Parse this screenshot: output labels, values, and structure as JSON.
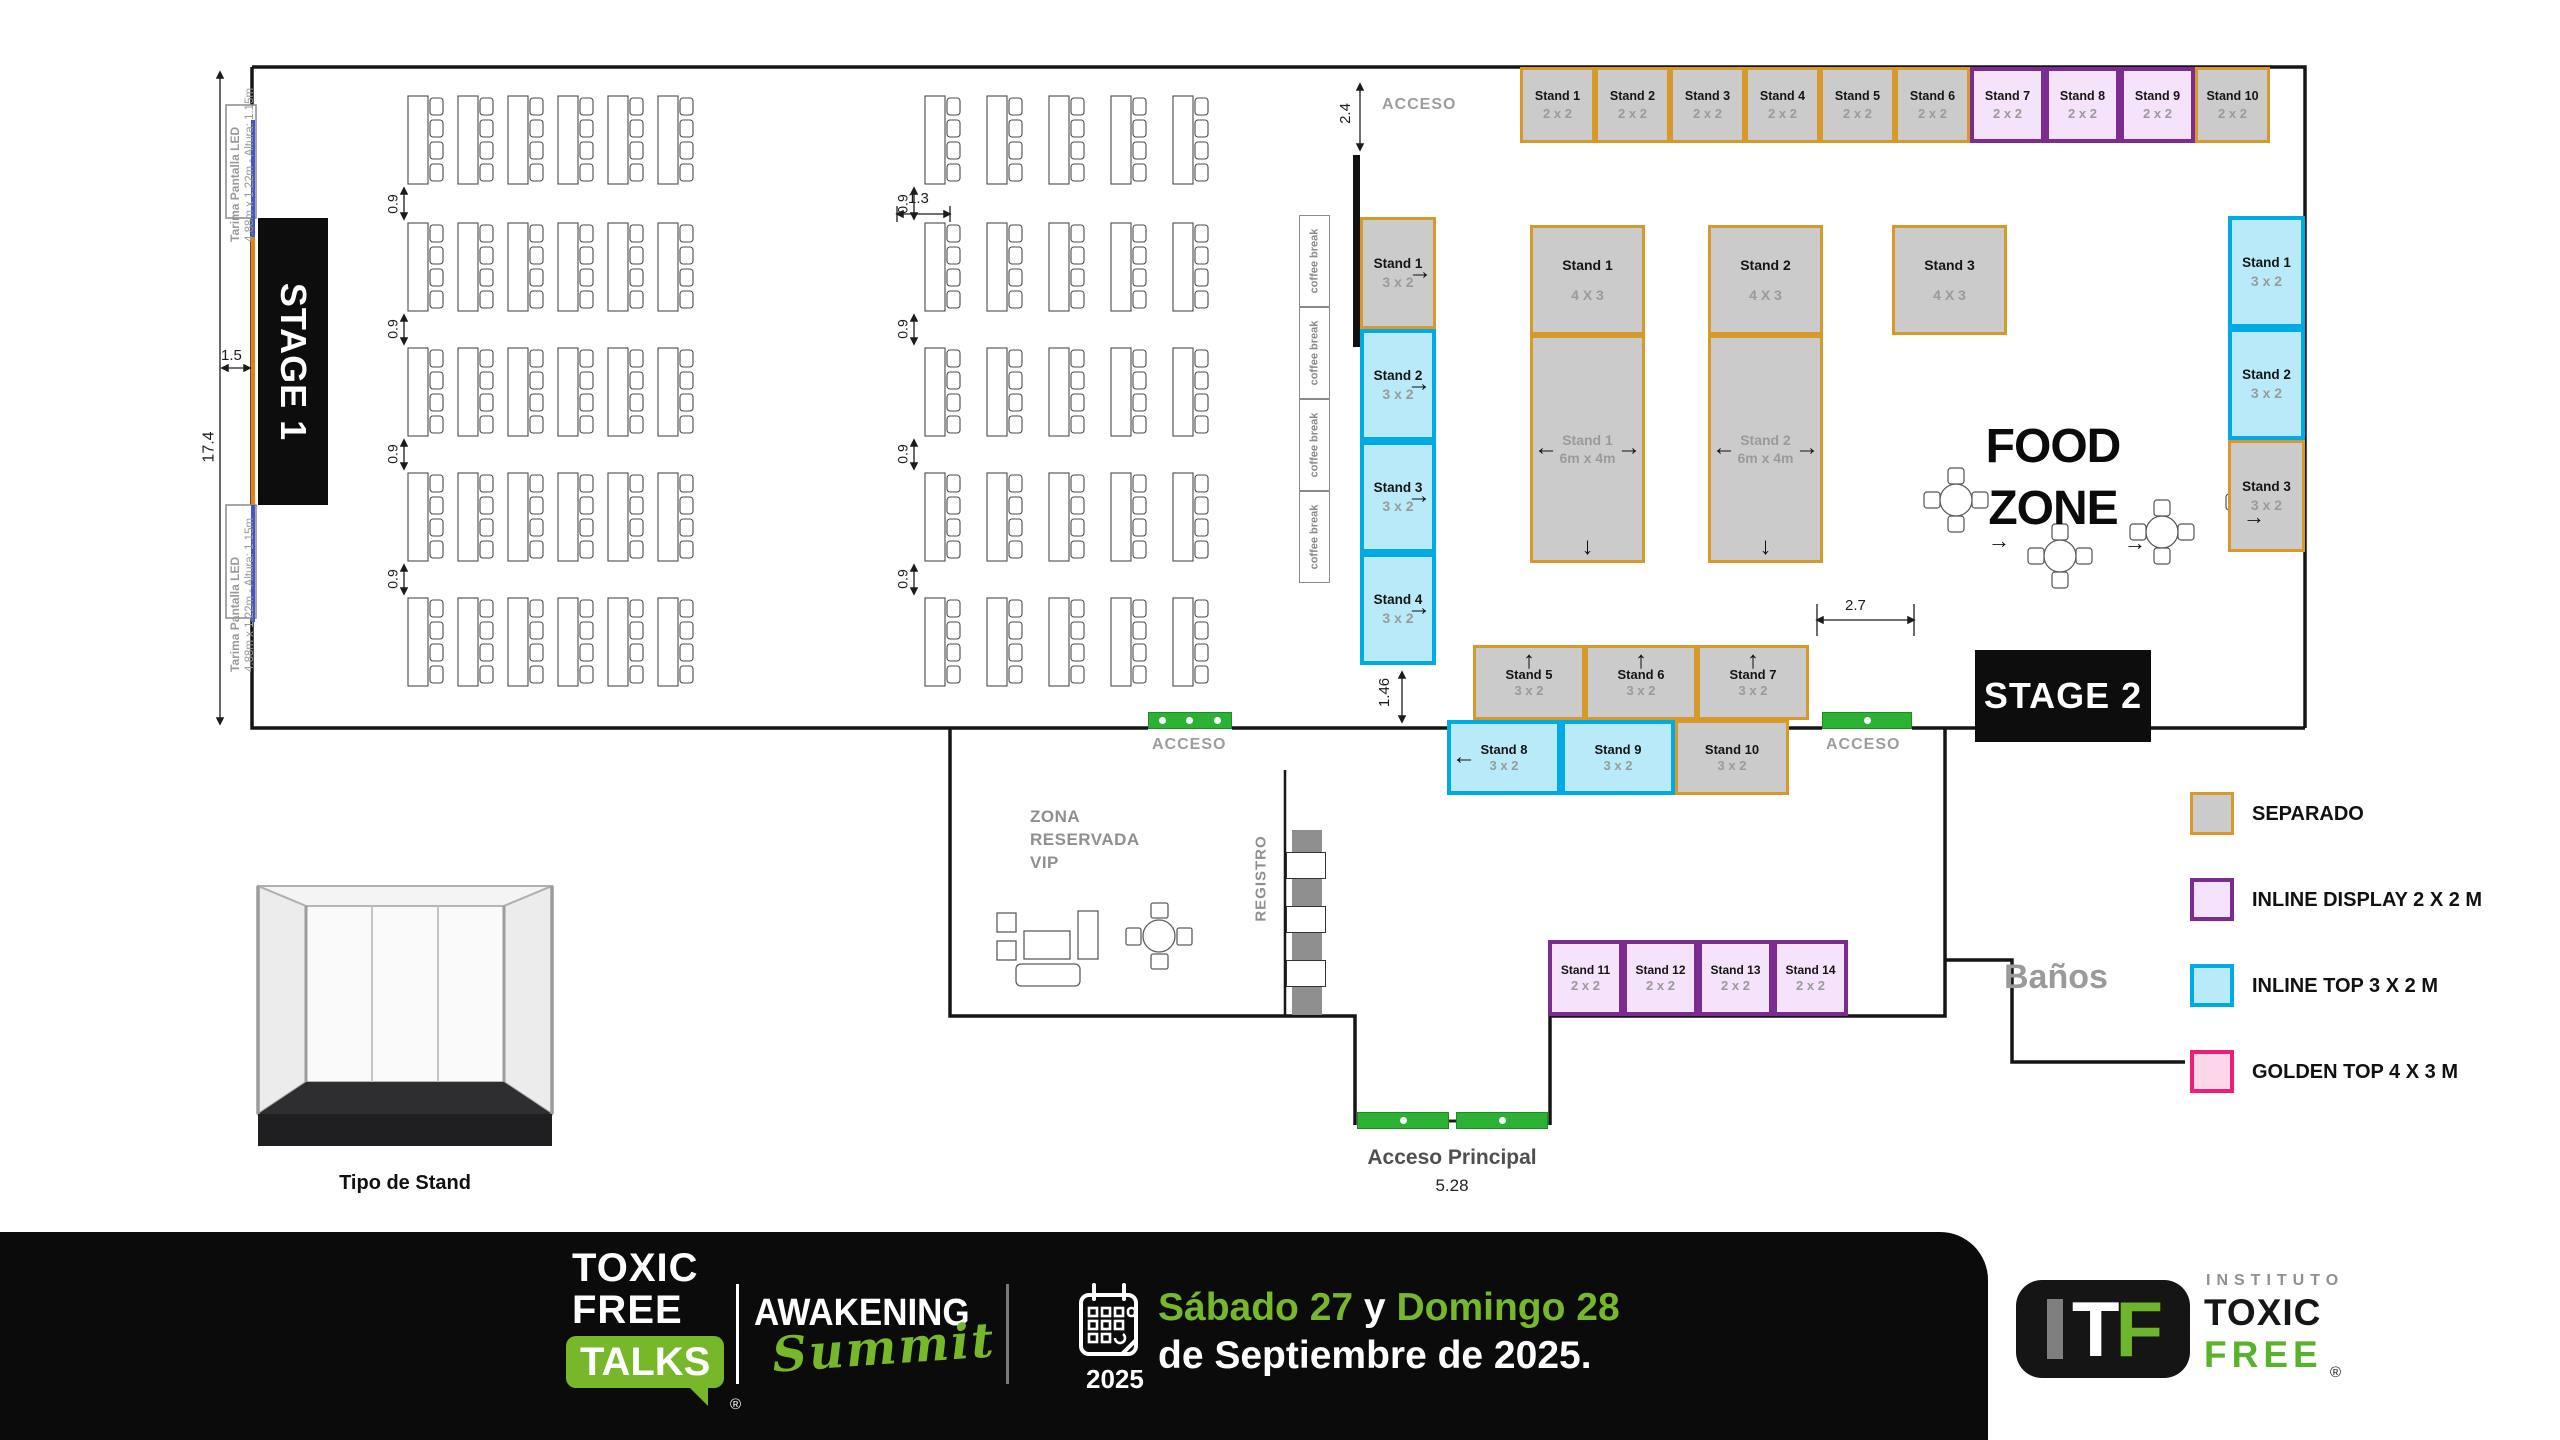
{
  "plan": {
    "stage1_label": "STAGE 1",
    "stage2_label": "STAGE 2",
    "food_zone": [
      "FOOD",
      "ZONE"
    ],
    "banos_label": "Baños",
    "acceso_label": "ACCESO",
    "acceso_principal_label": "Acceso Principal",
    "registro_label": "REGISTRO",
    "vip_lines": [
      "ZONA",
      "RESERVADA",
      "VIP"
    ],
    "coffee_break_label": "coffee break",
    "tarima_title": "Tarima Pantalla LED",
    "tarima_specs": "4.88m x 1.22m - Altura: 1.15m",
    "tipo_de_stand_label": "Tipo de Stand",
    "dimensions": {
      "hall_height": "17.4",
      "stage_offset": "1.5",
      "row_gap": "0.9",
      "cluster_gap": "1.3",
      "top_access": "2.4",
      "left_access": "1.46",
      "stage2_access": "2.7",
      "main_entrance": "5.28"
    }
  },
  "stands": {
    "top_row": [
      {
        "name": "Stand 1",
        "size": "2 x 2",
        "type": "separado"
      },
      {
        "name": "Stand 2",
        "size": "2 x 2",
        "type": "separado"
      },
      {
        "name": "Stand 3",
        "size": "2 x 2",
        "type": "separado"
      },
      {
        "name": "Stand 4",
        "size": "2 x 2",
        "type": "separado"
      },
      {
        "name": "Stand 5",
        "size": "2 x 2",
        "type": "separado"
      },
      {
        "name": "Stand 6",
        "size": "2 x 2",
        "type": "separado"
      },
      {
        "name": "Stand 7",
        "size": "2 x 2",
        "type": "inline_display"
      },
      {
        "name": "Stand 8",
        "size": "2 x 2",
        "type": "inline_display"
      },
      {
        "name": "Stand 9",
        "size": "2 x 2",
        "type": "inline_display"
      },
      {
        "name": "Stand 10",
        "size": "2 x 2",
        "type": "separado"
      }
    ],
    "left_column": [
      {
        "name": "Stand 1",
        "size": "3 x 2",
        "type": "separado",
        "arrows": [
          "right"
        ]
      },
      {
        "name": "Stand 2",
        "size": "3 x 2",
        "type": "inline_top",
        "arrows": [
          "right"
        ]
      },
      {
        "name": "Stand 3",
        "size": "3 x 2",
        "type": "inline_top",
        "arrows": [
          "right"
        ]
      },
      {
        "name": "Stand 4",
        "size": "3 x 2",
        "type": "inline_top",
        "arrows": [
          "right"
        ]
      }
    ],
    "center_large": [
      {
        "name": "Stand 1",
        "size": "4 X 3",
        "type": "separado"
      },
      {
        "name": "Stand 2",
        "size": "4 X 3",
        "type": "separado"
      },
      {
        "name": "Stand 3",
        "size": "4 X 3",
        "type": "separado"
      }
    ],
    "center_separado": [
      {
        "name": "Stand 1",
        "size": "6m x 4m",
        "type": "separado",
        "muted": true,
        "arrows": [
          "left",
          "right",
          "down"
        ]
      },
      {
        "name": "Stand 2",
        "size": "6m x 4m",
        "type": "separado",
        "muted": true,
        "arrows": [
          "left",
          "right",
          "down"
        ]
      }
    ],
    "right_column": [
      {
        "name": "Stand 1",
        "size": "3 x 2",
        "type": "inline_top"
      },
      {
        "name": "Stand 2",
        "size": "3 x 2",
        "type": "inline_top"
      },
      {
        "name": "Stand 3",
        "size": "3 x 2",
        "type": "separado"
      }
    ],
    "bottom_upper": [
      {
        "name": "Stand 5",
        "size": "3 x 2",
        "type": "separado",
        "arrows": [
          "up"
        ]
      },
      {
        "name": "Stand 6",
        "size": "3 x 2",
        "type": "separado",
        "arrows": [
          "up"
        ]
      },
      {
        "name": "Stand 7",
        "size": "3 x 2",
        "type": "separado",
        "arrows": [
          "up"
        ]
      }
    ],
    "bottom_lower": [
      {
        "name": "Stand 8",
        "size": "3 x 2",
        "type": "inline_top",
        "arrows": [
          "left"
        ]
      },
      {
        "name": "Stand 9",
        "size": "3 x 2",
        "type": "inline_top"
      },
      {
        "name": "Stand 10",
        "size": "3 x 2",
        "type": "separado"
      }
    ],
    "lobby_row": [
      {
        "name": "Stand 11",
        "size": "2 x 2",
        "type": "inline_display"
      },
      {
        "name": "Stand 12",
        "size": "2 x 2",
        "type": "inline_display"
      },
      {
        "name": "Stand 13",
        "size": "2 x 2",
        "type": "inline_display"
      },
      {
        "name": "Stand 14",
        "size": "2 x 2",
        "type": "inline_display"
      }
    ]
  },
  "legend": [
    {
      "label": "SEPARADO",
      "type": "separado"
    },
    {
      "label": "INLINE DISPLAY 2 X 2 M",
      "type": "inline_display"
    },
    {
      "label": "INLINE TOP 3 X 2 M",
      "type": "inline_top"
    },
    {
      "label": "GOLDEN TOP 4 X 3 M",
      "type": "golden_top"
    }
  ],
  "colors": {
    "separado_fill": "#cbcbcb",
    "separado_border": "#d6992b",
    "inline_display_fill": "#f5e3fb",
    "inline_display_border": "#7c2c91",
    "inline_top_fill": "#b9eafa",
    "inline_top_border": "#00abe5",
    "golden_top_fill": "#fcd7e8",
    "golden_top_border": "#ee1d75",
    "access_green": "#2db135",
    "brand_green": "#76b82a"
  },
  "footer": {
    "logo_line1": "TOXIC",
    "logo_line2": "FREE",
    "logo_badge": "TALKS",
    "registered": "®",
    "event_name": "AWAKENING",
    "event_script": "Summit",
    "event_year": "2025",
    "date_part1": "Sábado 27",
    "date_joiner": " y ",
    "date_part2": "Domingo 28",
    "date_line2": "de Septiembre de 2025.",
    "itf_i": "I",
    "itf_t": "T",
    "itf_f": "F",
    "itf_instituto": "INSTITUTO",
    "itf_toxic": "TOXIC",
    "itf_free": "FREE",
    "itf_registered": "®"
  }
}
